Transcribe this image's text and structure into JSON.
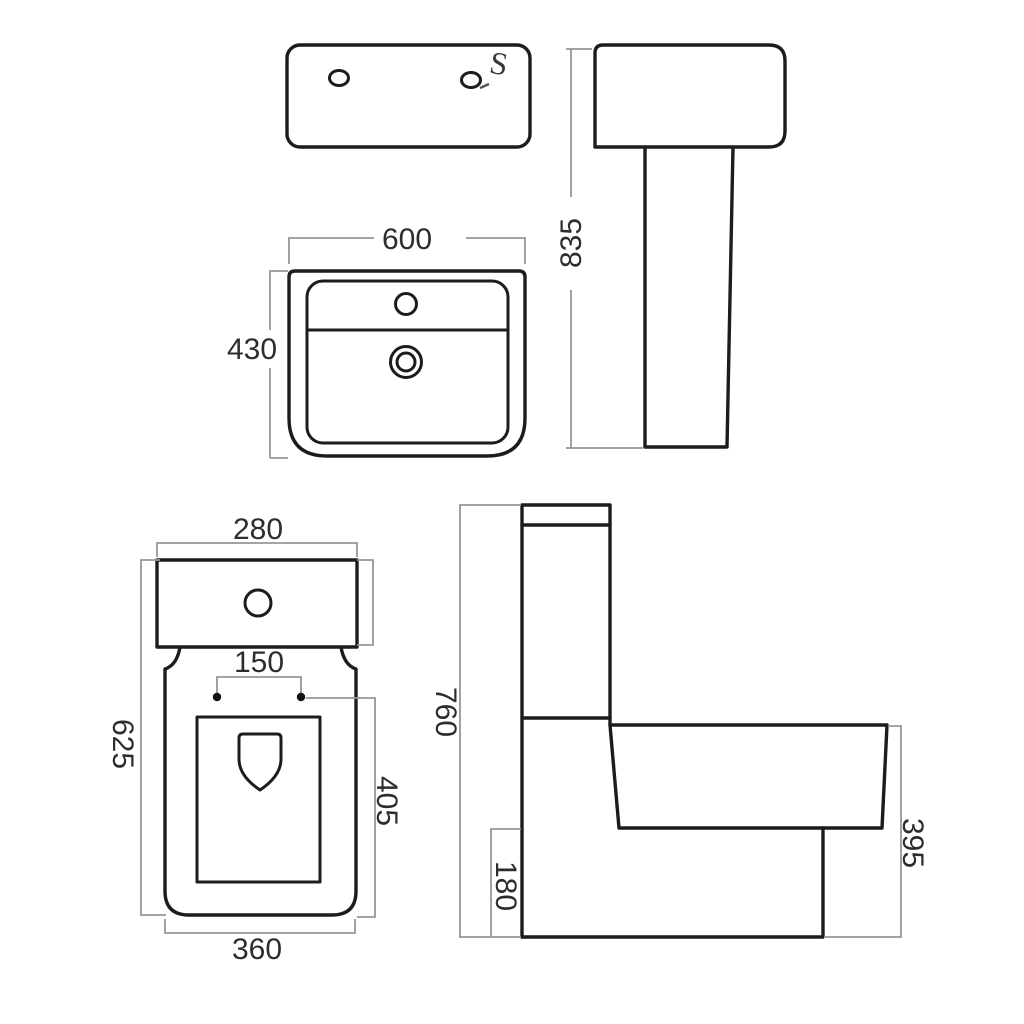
{
  "colors": {
    "background": "#ffffff",
    "outline": "#1c1c1c",
    "dimension_line": "#979797",
    "dimension_text": "#2d2d2d"
  },
  "views": {
    "basin_top": {
      "screw_glyph": "S"
    },
    "basin_front": {
      "width": "600",
      "height": "430"
    },
    "basin_side": {
      "height": "835"
    },
    "toilet_top": {
      "cistern_width": "280",
      "depth": "625",
      "hinge_spacing": "150",
      "seat_depth": "405",
      "pan_width": "360"
    },
    "toilet_side": {
      "height": "760",
      "base_height": "180",
      "seat_height": "395"
    }
  }
}
